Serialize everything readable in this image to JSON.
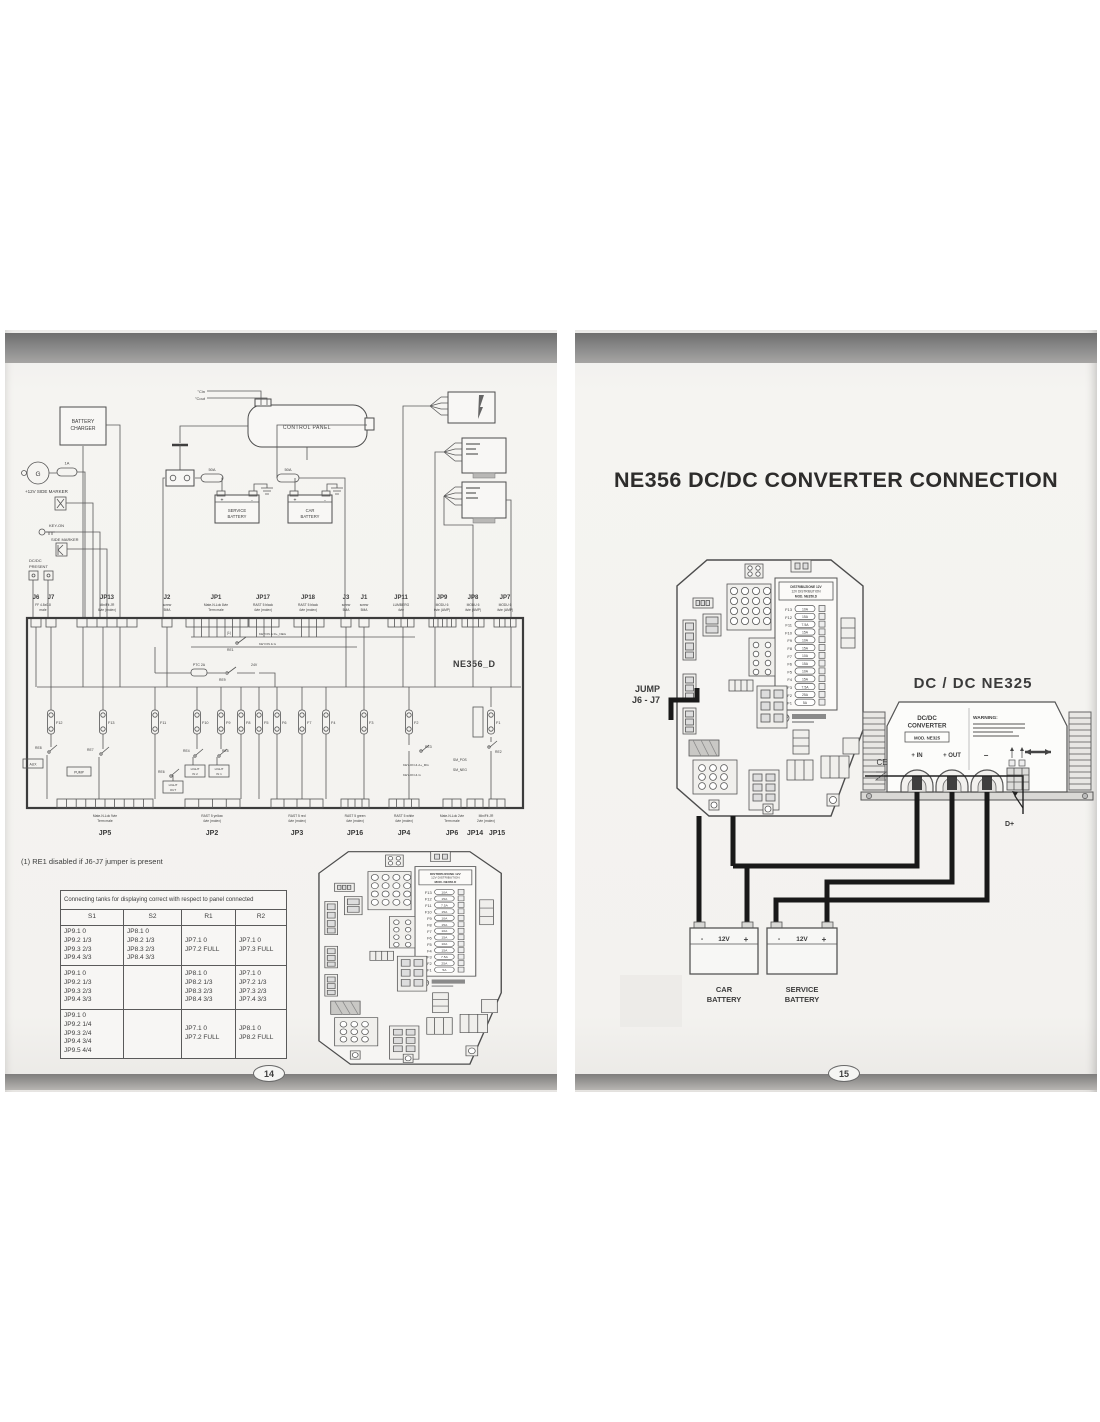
{
  "colors": {
    "paper": "#f3f2ef",
    "ink": "#3b3b3b",
    "wire": "#191919",
    "scan_bar": "#8d8d8d"
  },
  "p14": {
    "number": "14",
    "note": "(1) RE1 disabled if J6-J7 jumper is present",
    "top": {
      "tc_in": "°Cin",
      "tc_out": "°Cout",
      "control_panel": "CONTROL PANEL",
      "battery_charger": [
        "BATTERY",
        "CHARGER"
      ],
      "dynamo": "G",
      "fuse_1a": "1A",
      "side_marker_12v": "+12V SIDE MARKER",
      "key_on": "KEY-ON",
      "side_marker": "SIDE MARKER",
      "dcdc_present": [
        "DC/DC",
        "PRESENT"
      ],
      "fuse_50a_1": "50A",
      "fuse_50a_2": "50A",
      "service_battery": [
        "SERVICE",
        "BATTERY"
      ],
      "car_battery": [
        "CAR",
        "BATTERY"
      ],
      "plus": "+",
      "minus": "-"
    },
    "conn_top": [
      {
        "id": "J6",
        "d1": "FF 4.8x0.8",
        "d2": "male"
      },
      {
        "id": "J7",
        "d1": "",
        "d2": ""
      },
      {
        "id": "JP13",
        "d1": "MiniFit JR",
        "d2": "6vie (molex)"
      },
      {
        "id": "J2",
        "d1": "screw",
        "d2": "5MA"
      },
      {
        "id": "JP1",
        "d1": "Mate-N-Lok 8vie",
        "d2": "Term male"
      },
      {
        "id": "JP17",
        "d1": "RAST 5 black",
        "d2": "4vie (molex)"
      },
      {
        "id": "JP18",
        "d1": "RAST 5 black",
        "d2": "4vie (molex)"
      },
      {
        "id": "J3",
        "d1": "screw",
        "d2": "5MA"
      },
      {
        "id": "J1",
        "d1": "screw",
        "d2": "5MA"
      },
      {
        "id": "JP11",
        "d1": "LUMBERG",
        "d2": "4vie"
      },
      {
        "id": "JP9",
        "d1": "MODU 6",
        "d2": "6vie (AMP)"
      },
      {
        "id": "JP8",
        "d1": "MODU 6",
        "d2": "4vie (AMP)"
      },
      {
        "id": "JP7",
        "d1": "MODU 6",
        "d2": "4vie (AMP)"
      }
    ],
    "board": {
      "name": "NE356_D",
      "note_ref": "(1)",
      "re1": "RE1",
      "re9": "RE9",
      "ptc": "PTC 2A",
      "v24": "24V",
      "keyon_dneg": "KEYON & D+_NEG",
      "keyon_g": "KEYON & G",
      "fuses": [
        "F12",
        "F13",
        "F11",
        "F10",
        "F9",
        "F8",
        "F5",
        "F6",
        "F7",
        "F4",
        "F3",
        "F2",
        "F1"
      ],
      "re8": "RE8",
      "aux": "AUX",
      "re7": "RE7",
      "pump": "PUMP",
      "re6": "RE6",
      "light_out": [
        "LIGHT",
        "OUT"
      ],
      "re4": "RE4",
      "light_in2": [
        "LIGHT",
        "IN 2"
      ],
      "re5": "RE5",
      "light_in1": [
        "LIGHT",
        "IN 1"
      ],
      "re3": "RE3",
      "keyon_amg": "KEY-ON & A+_MG",
      "keyon_g2": "KEY-ON & G",
      "sm_pos": "SM_POS",
      "sm_neg": "SM_NEG",
      "re2": "RE2"
    },
    "conn_bottom": [
      {
        "id": "JP5",
        "d1": "Mate-N-Lok 9vie",
        "d2": "Term male"
      },
      {
        "id": "JP2",
        "d1": "RAST 5 yellow",
        "d2": "4vie (molex)"
      },
      {
        "id": "JP3",
        "d1": "RAST 5 red",
        "d2": "4vie (molex)"
      },
      {
        "id": "JP16",
        "d1": "RAST 5 green",
        "d2": "4vie (molex)"
      },
      {
        "id": "JP4",
        "d1": "RAST 5 white",
        "d2": "4vie (molex)"
      },
      {
        "id": "JP6",
        "d1": "Mate-N-Lok 2vie",
        "d2": "Term male"
      },
      {
        "id": "JP14",
        "d1": "MiniFit JR",
        "d2": "2vie (molex)"
      },
      {
        "id": "JP15",
        "d1": "",
        "d2": ""
      }
    ],
    "table": {
      "title": "Connecting tanks for displaying correct with respect to panel connected",
      "columns": [
        "S1",
        "S2",
        "R1",
        "R2"
      ],
      "rows": [
        {
          "s1": [
            "JP9.1  0",
            "JP9.2  1/3",
            "JP9.3  2/3",
            "JP9.4  3/3"
          ],
          "s2": [
            "JP8.1  0",
            "JP8.2  1/3",
            "JP8.3  2/3",
            "JP8.4  3/3"
          ],
          "r1": [
            "JP7.1  0",
            "JP7.2  FULL"
          ],
          "r2": [
            "JP7.1  0",
            "JP7.3  FULL"
          ]
        },
        {
          "s1": [
            "JP9.1  0",
            "JP9.2  1/3",
            "JP9.3  2/3",
            "JP9.4  3/3"
          ],
          "s2": [],
          "r1": [
            "JP8.1  0",
            "JP8.2  1/3",
            "JP8.3  2/3",
            "JP8.4  3/3"
          ],
          "r2": [
            "JP7.1  0",
            "JP7.2  1/3",
            "JP7.3  2/3",
            "JP7.4  3/3"
          ]
        },
        {
          "s1": [
            "JP9.1  0",
            "JP9.2  1/4",
            "JP9.3  2/4",
            "JP9.4  3/4",
            "JP9.5  4/4"
          ],
          "s2": [],
          "r1": [
            "JP7.1  0",
            "JP7.2  FULL"
          ],
          "r2": [
            "JP8.1  0",
            "JP8.2  FULL"
          ]
        }
      ]
    }
  },
  "p15": {
    "number": "15",
    "title": "NE356 DC/DC CONVERTER CONNECTION",
    "jump": [
      "JUMP",
      "J6 - J7"
    ],
    "heading": "DC / DC   NE325",
    "converter": {
      "line1": "DC/DC",
      "line2": "CONVERTER",
      "model": "MOD. NE325",
      "warning": "WARNING:",
      "ce": "CE",
      "t_in": "+ IN",
      "t_out": "+ OUT",
      "t_minus": "−",
      "dplus": "D+"
    },
    "fuse_panel": {
      "h1": "DISTRIBUZIONE 12V",
      "h2": "12V DISTRIBUTION",
      "h3": "MOD. NE356.D",
      "fuses": [
        {
          "id": "F13",
          "amp": "10A"
        },
        {
          "id": "F12",
          "amp": "15A"
        },
        {
          "id": "F11",
          "amp": "7.5A"
        },
        {
          "id": "F10",
          "amp": "15A"
        },
        {
          "id": "F9",
          "amp": "10A"
        },
        {
          "id": "F8",
          "amp": "15A"
        },
        {
          "id": "F7",
          "amp": "10A"
        },
        {
          "id": "F6",
          "amp": "15A"
        },
        {
          "id": "F5",
          "amp": "10A"
        },
        {
          "id": "F4",
          "amp": "15A"
        },
        {
          "id": "F3",
          "amp": "7.5A"
        },
        {
          "id": "F2",
          "amp": "25A"
        },
        {
          "id": "F1",
          "amp": "5A"
        }
      ]
    },
    "batteries": [
      {
        "n1": "CAR",
        "n2": "BATTERY",
        "v": "12V"
      },
      {
        "n1": "SERVICE",
        "n2": "BATTERY",
        "v": "12V"
      }
    ],
    "sign_plus": "+",
    "sign_minus": "-"
  }
}
